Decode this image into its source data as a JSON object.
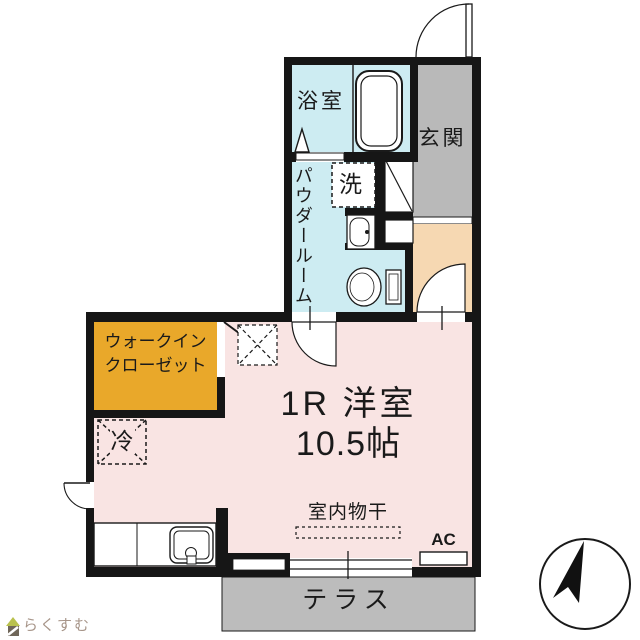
{
  "floorplan": {
    "rooms": {
      "bathroom": {
        "label": "浴室"
      },
      "powder_room": {
        "label": "パウダールーム"
      },
      "laundry": {
        "label": "洗"
      },
      "entrance": {
        "label": "玄関"
      },
      "walk_in_closet": {
        "label_line1": "ウォークイン",
        "label_line2": "クローゼット"
      },
      "refrigerator": {
        "label": "冷"
      },
      "main_room": {
        "type_label": "1R 洋室",
        "size_label": "10.5帖"
      },
      "indoor_drying": {
        "label": "室内物干"
      },
      "air_conditioner": {
        "label": "AC"
      },
      "terrace": {
        "label": "テラス"
      }
    },
    "colors": {
      "wet_area": "#cdecf2",
      "entrance_floor": "#b9b9b9",
      "hallway": "#f6d8b2",
      "closet": "#e9a82a",
      "room": "#f9e4e3",
      "terrace_floor": "#bcbcbc",
      "wall": "#161616",
      "logo_text": "#a79589",
      "logo_roof": "#b9c14e",
      "logo_body": "#6f6659"
    },
    "icons": {
      "compass": "north-arrow-icon",
      "logo": "house-icon"
    }
  },
  "branding": {
    "logo_text": "らくすむ"
  }
}
